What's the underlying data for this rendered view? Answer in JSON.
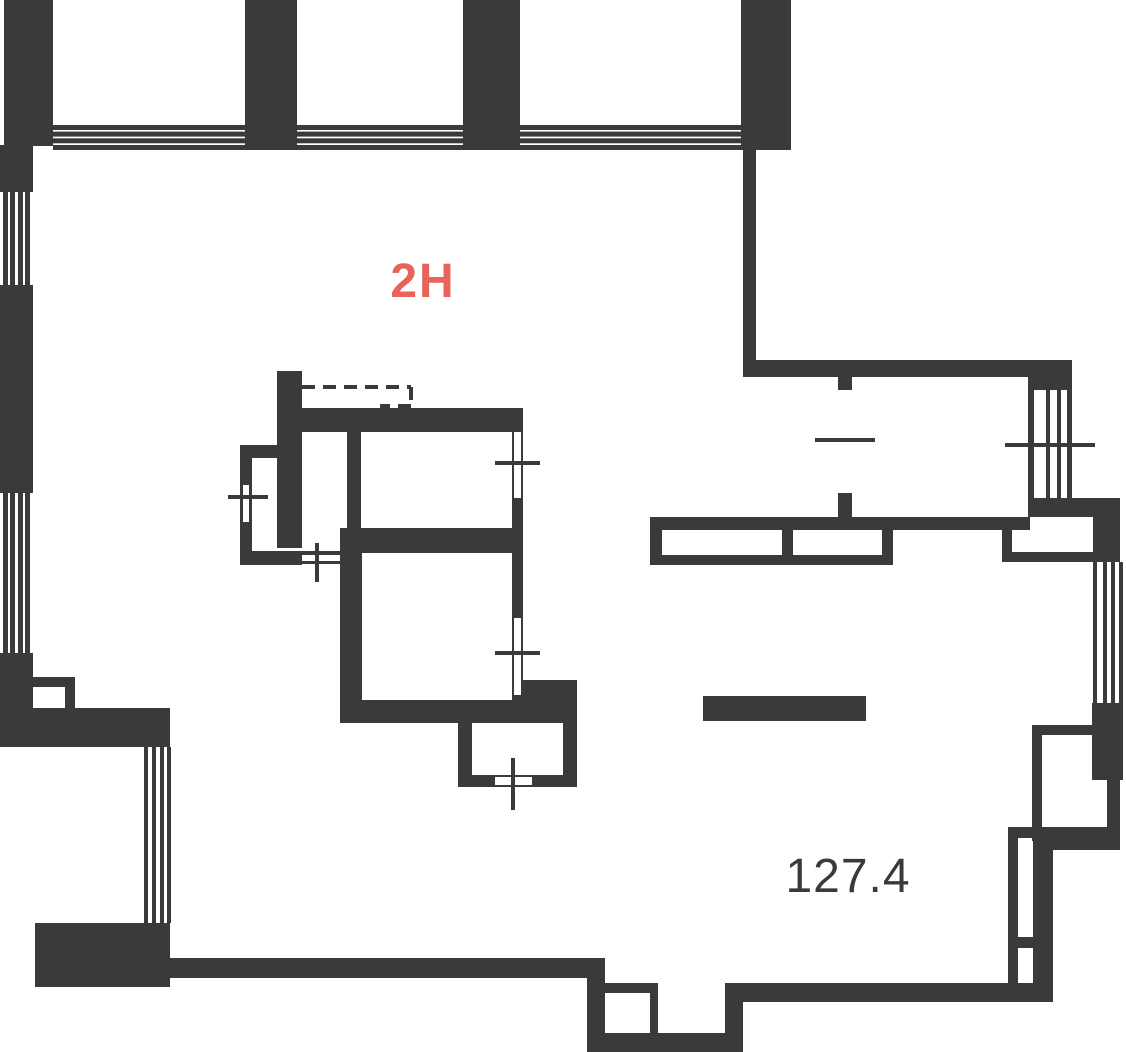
{
  "plan": {
    "unit_label": "2H",
    "area_label": "127.4",
    "colors": {
      "wall": "#3a3a3c",
      "accent": "#e8635a",
      "background": "#ffffff"
    }
  }
}
